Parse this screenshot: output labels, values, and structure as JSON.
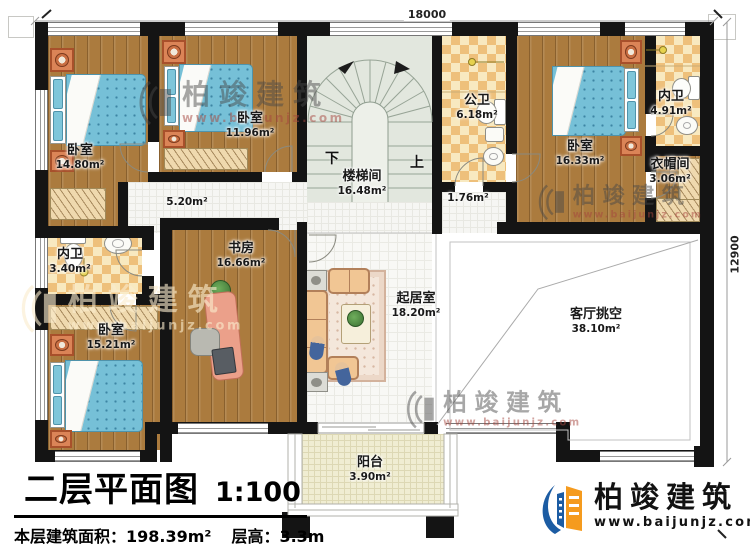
{
  "plan": {
    "dimension_top": "18000",
    "dimension_right": "12900",
    "rooms": {
      "bedroom_top_left": {
        "name": "卧室",
        "area": "14.80m²"
      },
      "bedroom_top_middle": {
        "name": "卧室",
        "area": "11.96m²"
      },
      "bedroom_top_right": {
        "name": "卧室",
        "area": "16.33m²"
      },
      "bedroom_bottom_left": {
        "name": "卧室",
        "area": "15.21m²"
      },
      "stairwell": {
        "name": "楼梯间",
        "area": "16.48m²",
        "down_label": "下",
        "up_label": "上"
      },
      "public_bath": {
        "name": "公卫",
        "area": "6.18m²"
      },
      "ensuite_top_right": {
        "name": "内卫",
        "area": "4.91m²"
      },
      "ensuite_left": {
        "name": "内卫",
        "area": "3.40m²"
      },
      "cloakroom": {
        "name": "衣帽间",
        "area": "3.06m²"
      },
      "study": {
        "name": "书房",
        "area": "16.66m²"
      },
      "living": {
        "name": "起居室",
        "area": "18.20m²"
      },
      "living_void": {
        "name": "客厅挑空",
        "area": "38.10m²"
      },
      "balcony": {
        "name": "阳台",
        "area": "3.90m²"
      },
      "hallway": {
        "area": "5.20m²"
      },
      "landing": {
        "area": "1.76m²"
      }
    }
  },
  "title_block": {
    "title": "二层平面图",
    "scale": "1:100",
    "floor_area_label": "本层建筑面积：198.39m²",
    "floor_height_label": "层高：3.3m"
  },
  "brand": {
    "name": "柏竣建筑",
    "url": "www.baijunjz.com"
  },
  "watermark": {
    "name": "柏竣建筑",
    "url": "www.baijunjz.com"
  },
  "colors": {
    "wall": "#141414",
    "wood_floor": "#ab7b3e",
    "bath_tile": "#eec07b",
    "bed_blue": "#79c2d8",
    "stair_floor": "#e2e7de",
    "balcony_floor": "#f0edd2",
    "brand_blue": "#1c5ca3",
    "brand_orange": "#f59b1e",
    "watermark_red": "#a5463e"
  }
}
